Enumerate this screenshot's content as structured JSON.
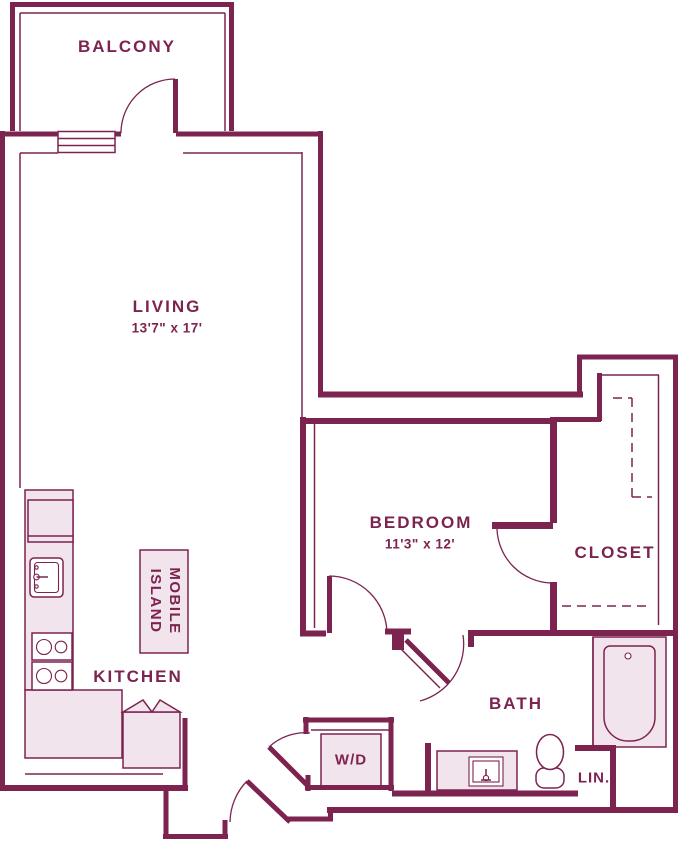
{
  "colors": {
    "wall": "#7C2350",
    "label_text": "#7C2350",
    "fixture_fill": "#F2E4EC",
    "background": "#FFFFFF"
  },
  "rooms": {
    "balcony": {
      "label": "BALCONY"
    },
    "living": {
      "label": "LIVING",
      "dimensions": "13'7\" x 17'"
    },
    "bedroom": {
      "label": "BEDROOM",
      "dimensions": "11'3\" x 12'"
    },
    "closet": {
      "label": "CLOSET"
    },
    "kitchen": {
      "label": "KITCHEN"
    },
    "bath": {
      "label": "BATH"
    },
    "laundry": {
      "label": "W/D"
    },
    "linen": {
      "label": "LIN."
    },
    "island": {
      "label": "MOBILE ISLAND"
    }
  },
  "fixtures": [
    "balcony-window",
    "refrigerator",
    "kitchen-sink",
    "stove-burners",
    "kitchen-counter",
    "base-cabinet",
    "mobile-island",
    "washer-dryer-box",
    "bathtub",
    "toilet",
    "vanity-sink",
    "closet-shelf-dashes"
  ]
}
